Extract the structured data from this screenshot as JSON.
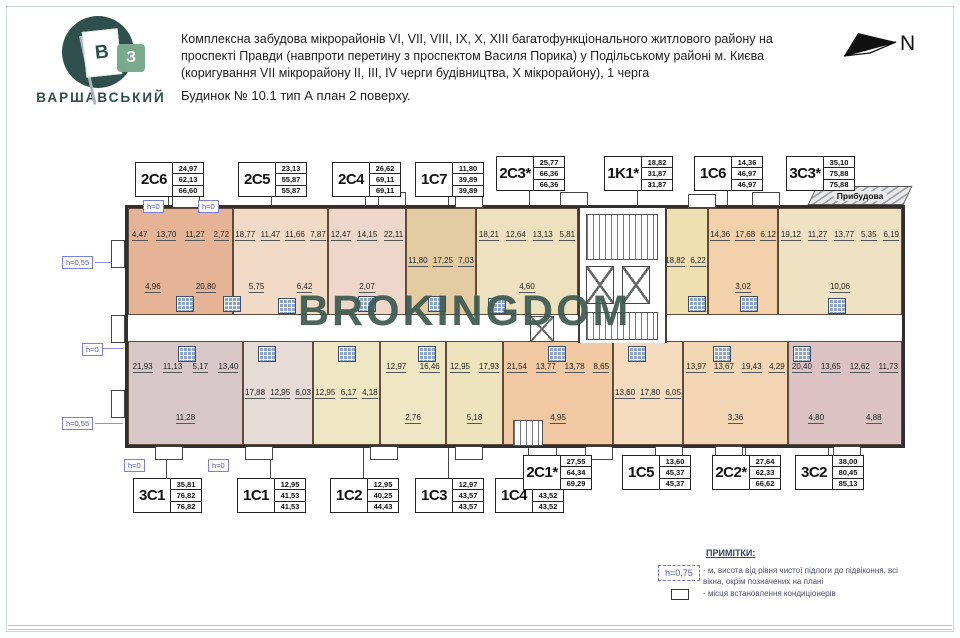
{
  "brand": {
    "name": "ВАРШАВСЬКИЙ",
    "flag_letter": "В",
    "square_letter": "З",
    "brand_color": "#2e4f4c",
    "green_color": "#7aa98e"
  },
  "header": {
    "description": "Комплексна забудова мікрорайонів VI, VII, VIII, IX, X, XIII багатофункціонального житлового району на проспекті Правди (навпроти перетину з проспектом Василя Порика) у Подільському районі м. Києва (коригування VII мікрорайону II, III, IV черги будівництва, X мікрорайону), 1 черга",
    "building_line": "Будинок № 10.1  тип А   план 2 поверху.",
    "north_label": "N"
  },
  "plan": {
    "watermark": "BROKINGDOM",
    "watermark_color": "#3d5a4f",
    "pribudova_label": "Прибудова",
    "annotation_color": "#5057c8",
    "top_units": [
      {
        "name": "2C6",
        "areas": [
          "24,97",
          "62,13",
          "66,60"
        ],
        "rooms": [
          "4,47",
          "13,70",
          "11,27",
          "2,72",
          "4,96",
          "20,80"
        ]
      },
      {
        "name": "2C5",
        "areas": [
          "23,13",
          "55,87",
          "55,87"
        ],
        "rooms": [
          "18,77",
          "11,47",
          "11,66",
          "7,87",
          "5,75",
          "6,42"
        ]
      },
      {
        "name": "2C4",
        "areas": [
          "26,62",
          "69,11",
          "69,11"
        ],
        "rooms": [
          "12,47",
          "14,15",
          "22,11",
          "2,07"
        ]
      },
      {
        "name": "1C7",
        "areas": [
          "11,80",
          "39,89",
          "39,89"
        ],
        "rooms": [
          "11,80",
          "17,25",
          "7,03"
        ]
      },
      {
        "name": "2C3*",
        "areas": [
          "25,77",
          "66,36",
          "66,36"
        ],
        "rooms": [
          "18,21",
          "12,64",
          "13,13",
          "5,81",
          "4,60"
        ]
      },
      {
        "name": "1K1*",
        "areas": [
          "18,82",
          "31,87",
          "31,87"
        ],
        "rooms": [
          "18,82",
          "6,22"
        ]
      },
      {
        "name": "1C6",
        "areas": [
          "14,36",
          "46,97",
          "46,97"
        ],
        "rooms": [
          "14,36",
          "17,68",
          "6,12",
          "3,02"
        ]
      },
      {
        "name": "3C3*",
        "areas": [
          "35,10",
          "75,88",
          "75,88"
        ],
        "rooms": [
          "19,12",
          "11,27",
          "13,77",
          "5,35",
          "6,19",
          "10,06"
        ]
      }
    ],
    "bottom_units": [
      {
        "name": "3C1",
        "areas": [
          "35,81",
          "76,82",
          "76,82"
        ],
        "rooms": [
          "21,93",
          "11,13",
          "5,17",
          "13,40",
          "11,28"
        ]
      },
      {
        "name": "1C1",
        "areas": [
          "12,95",
          "41,53",
          "41,53"
        ],
        "rooms": [
          "17,88",
          "12,95",
          "6,03"
        ]
      },
      {
        "name": "1C2",
        "areas": [
          "12,95",
          "40,25",
          "44,43"
        ],
        "rooms": [
          "12,95",
          "6,17",
          "4,18"
        ]
      },
      {
        "name": "1C3",
        "areas": [
          "12,97",
          "43,57",
          "43,57"
        ],
        "rooms": [
          "12,97",
          "16,46",
          "2,76"
        ]
      },
      {
        "name": "1C4",
        "areas": [
          "12,95",
          "43,52",
          "43,52"
        ],
        "rooms": [
          "12,95",
          "17,93",
          "5,18"
        ]
      },
      {
        "name": "2C1*",
        "areas": [
          "27,55",
          "64,34",
          "69,29"
        ],
        "rooms": [
          "21,54",
          "13,77",
          "13,78",
          "8,65",
          "4,95"
        ]
      },
      {
        "name": "1C5",
        "areas": [
          "13,60",
          "45,37",
          "45,37"
        ],
        "rooms": [
          "13,60",
          "17,80",
          "6,05"
        ]
      },
      {
        "name": "2C2*",
        "areas": [
          "27,64",
          "62,33",
          "66,62"
        ],
        "rooms": [
          "13,97",
          "13,67",
          "19,43",
          "4,29",
          "3,36"
        ]
      },
      {
        "name": "3C2",
        "areas": [
          "38,00",
          "80,45",
          "85,13"
        ],
        "rooms": [
          "20,40",
          "13,65",
          "12,62",
          "11,73",
          "4,80",
          "4,88"
        ]
      }
    ]
  },
  "annotations": {
    "h_labels": [
      "h=0",
      "h=0",
      "h=0,55",
      "h=0",
      "h=0,55",
      "h=0",
      "h=0"
    ]
  },
  "legend": {
    "title": "ПРИМІТКИ:",
    "h_badge": "h=0,75",
    "note1": "- м, висота від рівня чистої підлоги до підвіконня, всі вікна, окрім позначених на плані",
    "note2": "- місця встановлення кондиціонерів"
  }
}
